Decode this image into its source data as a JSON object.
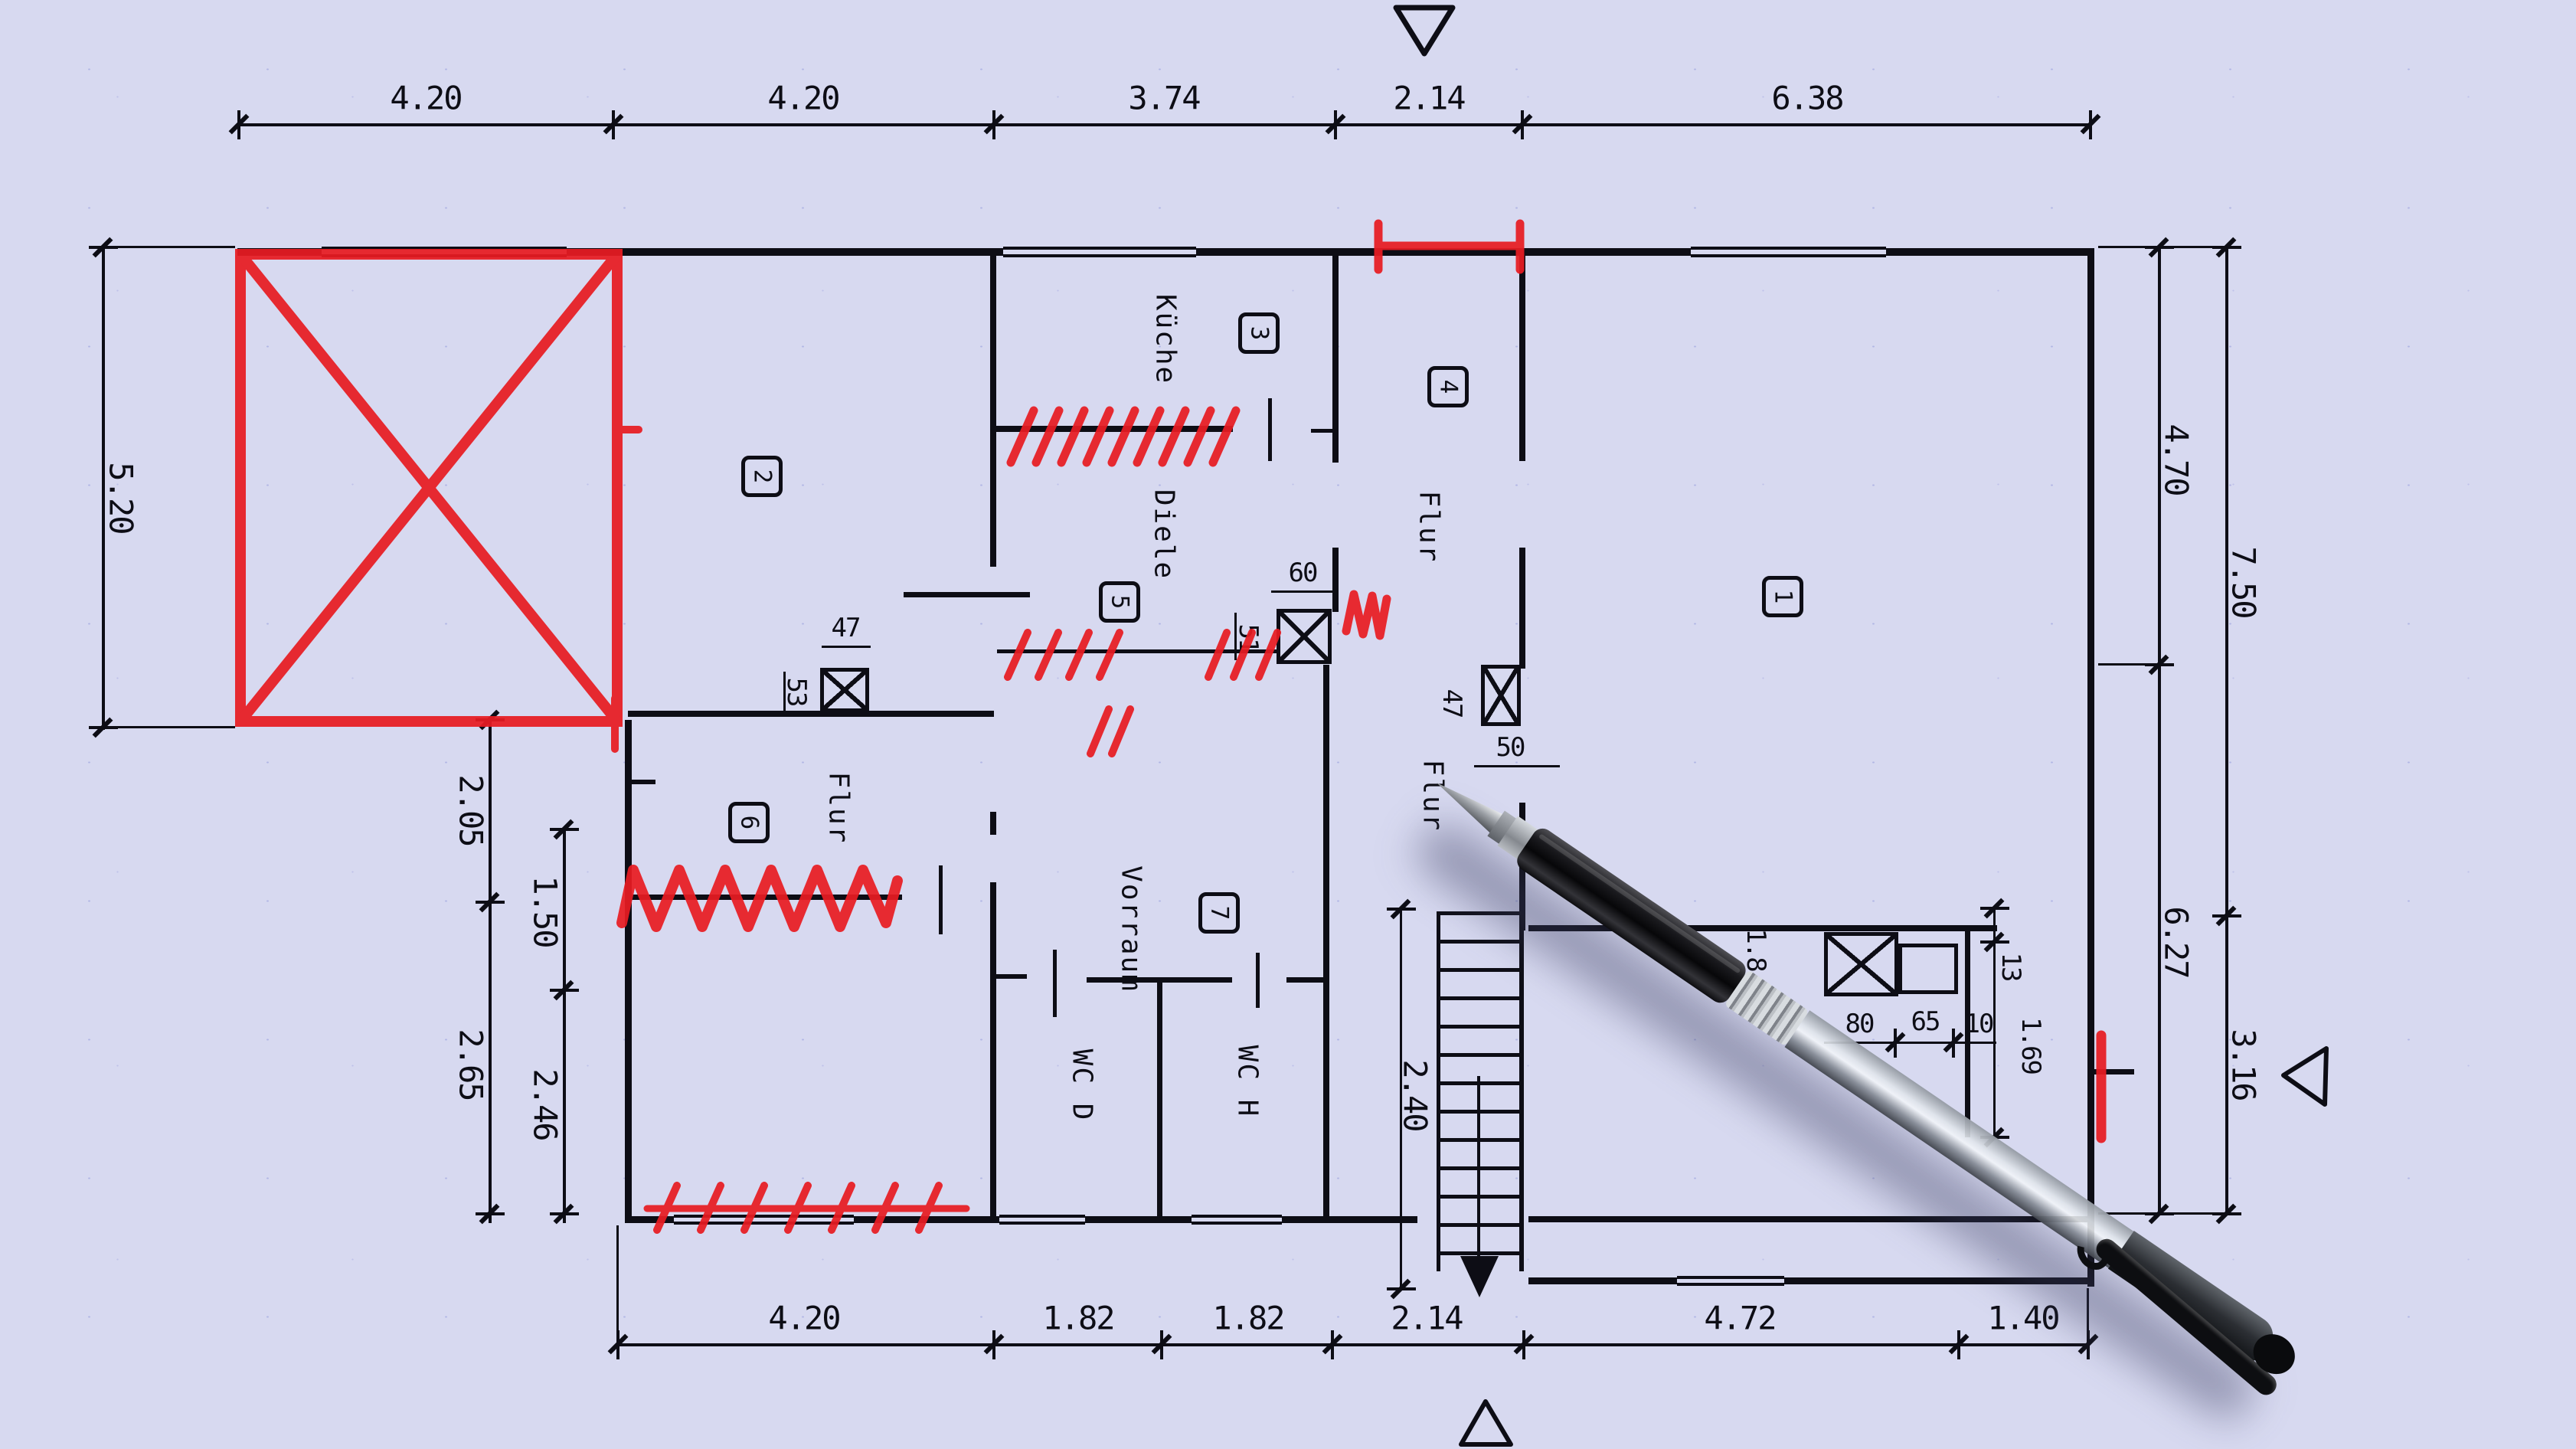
{
  "colors": {
    "paper": "#d7d9f0",
    "ink": "#0d0d15",
    "red": "#e81c22"
  },
  "room_numbers": {
    "r1": "1",
    "r2": "2",
    "r3": "3",
    "r4": "4",
    "r5": "5",
    "r6": "6",
    "r7": "7"
  },
  "room_labels": {
    "kueche": "Küche",
    "diele": "Diele",
    "flur_top": "Flur",
    "flur_left": "Flur",
    "flur_stairs": "Flur",
    "vorraum": "Vorraum",
    "wc_d": "WC D",
    "wc_h": "WC H"
  },
  "dims_top": [
    "4.20",
    "4.20",
    "3.74",
    "2.14",
    "6.38"
  ],
  "dims_bottom": [
    "4.20",
    "1.82",
    "1.82",
    "2.14",
    "4.72",
    "1.40"
  ],
  "dims_left": {
    "outer": "5.20",
    "a1": "2.05",
    "a2": "2.65",
    "b1": "1.50",
    "b2": "2.46"
  },
  "dims_right": {
    "inner1": "4.70",
    "inner2": "6.27",
    "outer1": "7.50",
    "outer2": "3.16"
  },
  "dims_detail": {
    "col_a_w": "47",
    "col_a_h": "53",
    "col_b_w": "60",
    "col_b_h": "51",
    "col_c": "47",
    "door": "50",
    "stairs": "2.40",
    "wall_t": "1.8",
    "chim_1": "80",
    "chim_2": "65",
    "chim_3": "10",
    "flue_t": "13",
    "flue_h": "1.69"
  }
}
